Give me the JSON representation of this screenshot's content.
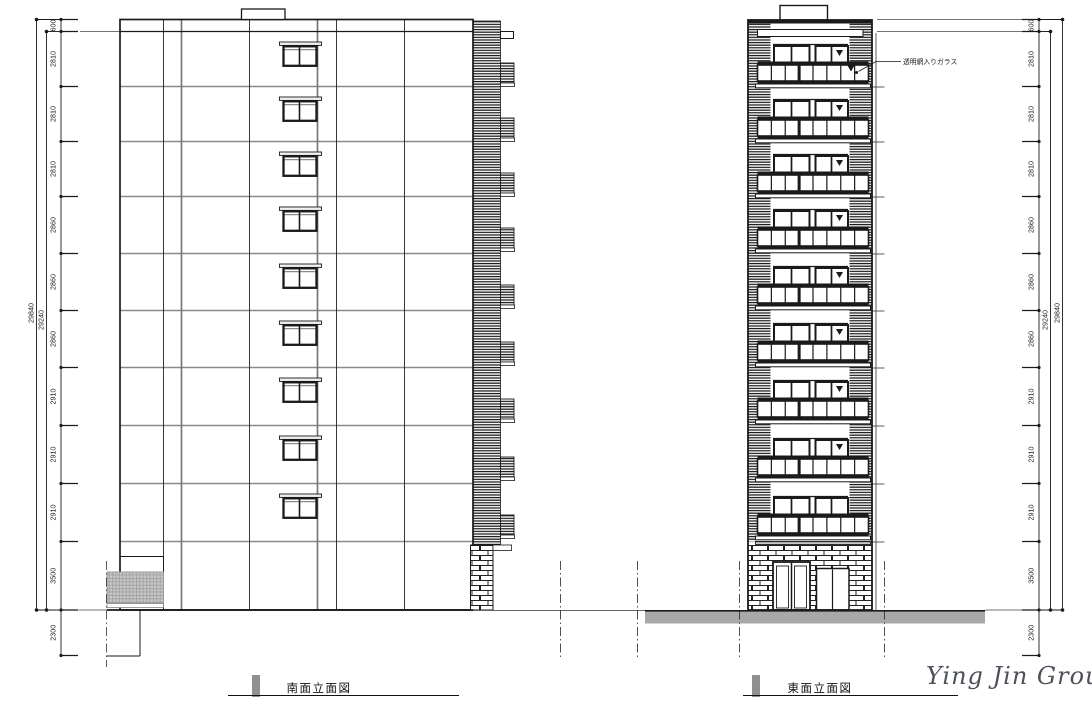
{
  "views": {
    "south": {
      "title": "南面立面図"
    },
    "east": {
      "title": "東面立面図"
    }
  },
  "annotation": {
    "label": "透明網入りガラス"
  },
  "signature": {
    "text": "Ying Jin Group"
  },
  "dimensions": {
    "parapet": "600",
    "floors_top_to_bottom": [
      "2810",
      "2810",
      "2810",
      "2860",
      "2860",
      "2860",
      "2910",
      "2910",
      "2910",
      "3500"
    ],
    "below_grade": "2300",
    "total_inner": "29240",
    "total_outer": "29840"
  },
  "colors": {
    "line": "#1a1a1a",
    "gray_line": "#8a8a8a",
    "ground_band": "#a8a8a8",
    "mesh_fill": "#c6c6c6"
  }
}
